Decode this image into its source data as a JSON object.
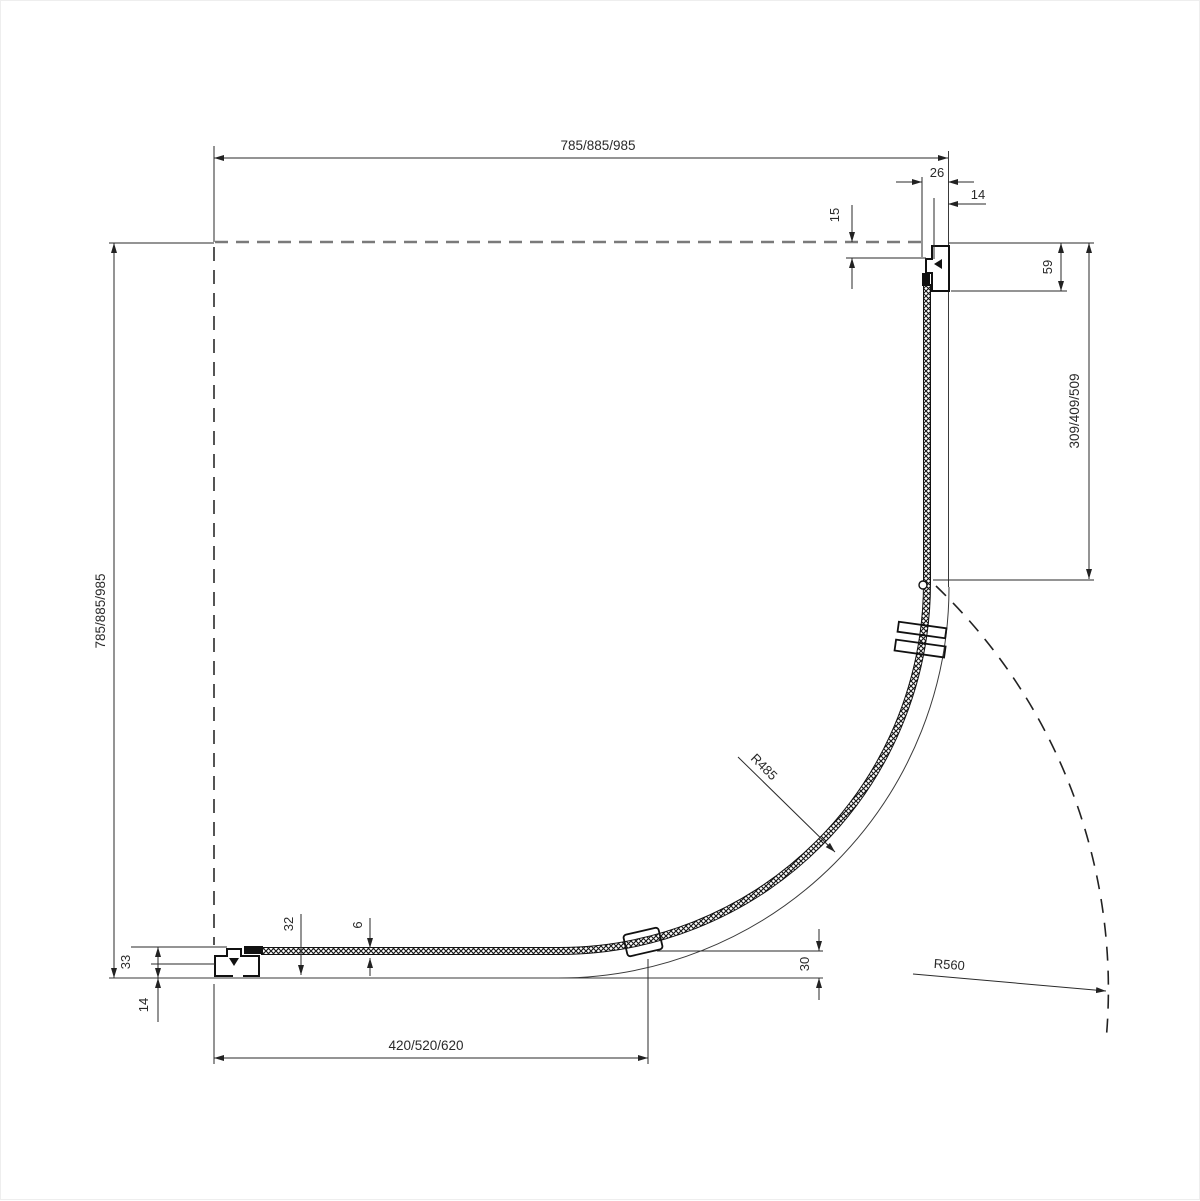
{
  "meta": {
    "title": "Quadrant shower enclosure technical plan drawing"
  },
  "colors": {
    "line": "#2a2a2a",
    "heavy_line": "#111111",
    "dashed_wall_axis": "#7a7a7a",
    "background": "#ffffff"
  },
  "dimensions": {
    "top_width": "785/885/985",
    "left_depth": "785/885/985",
    "bottom_fixed_glass": "420/520/620",
    "right_fixed_glass": "309/409/509",
    "wall_profile_depth": "59",
    "wall_profile_offset": "15",
    "profile_width_top": "26",
    "glass_inset_top": "14",
    "profile_height_left": "33",
    "wall_offset_left": "14",
    "profile_height_bottom": "32",
    "glass_thickness": "6",
    "door_edge_gap": "30",
    "glass_radius": "R485",
    "entry_swing_radius": "R560"
  }
}
